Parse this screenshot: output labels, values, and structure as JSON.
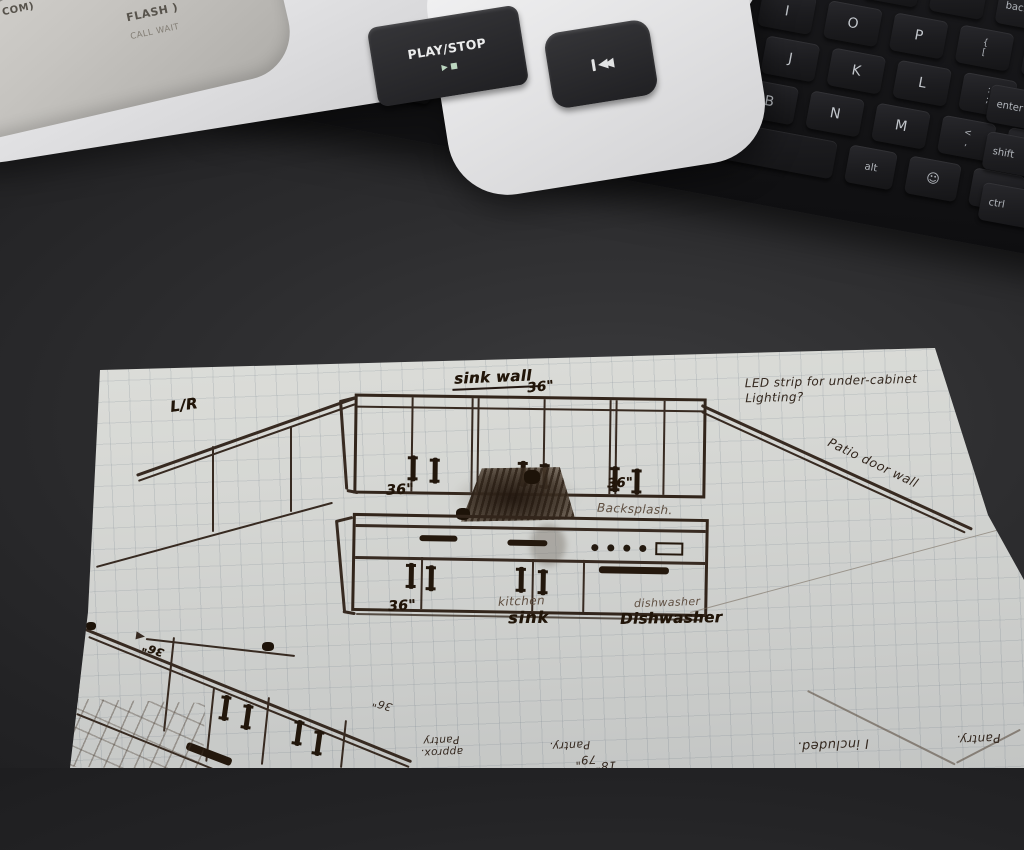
{
  "phone": {
    "com_fragment": "COM",
    "flash_label": "FLASH",
    "speaker_mark": ")",
    "call_wait_label": "CALL WAIT",
    "play_stop_label": "PLAY/STOP",
    "play_icons": "▶ ■",
    "skip_icon_name": "skip-back-icon"
  },
  "keyboard": {
    "rows": {
      "num": [
        "-",
        "=",
        "backspace"
      ],
      "top": [
        "Y",
        "U",
        "I",
        "O",
        "P",
        "{ [",
        "} ]"
      ],
      "home": [
        "A",
        "S",
        "D",
        "F",
        "G",
        "H",
        "J",
        "K",
        "L",
        ": ;",
        "\" '"
      ],
      "z": [
        "shift",
        "fn-lock",
        "Z",
        "X",
        "C",
        "V",
        "B",
        "N",
        "M",
        "< ,",
        "> .",
        "? /"
      ],
      "bottom": [
        "ctrl",
        "fn",
        "win",
        "alt",
        "space",
        "alt",
        "smiley",
        "mic",
        "ctrl"
      ]
    },
    "right_fragments": [
      "enter",
      "shift",
      "ctrl"
    ],
    "smiley_glyph": "☺"
  },
  "paper": {
    "title_text": "sink wall",
    "title_dim": "36\"",
    "corner_mark": "L/R",
    "led_note_line1": "LED strip for under-cabinet",
    "led_note_line2": "Lighting?",
    "upper_dim_left": "36\"",
    "upper_dim_right": "36\"",
    "backsplash": "Backsplash.",
    "patio_wall": "Patio door wall",
    "lower_dim": "36\"",
    "sink_label_light": "kitchen",
    "sink_label_bold": "sink",
    "dishwasher_light": "dishwasher",
    "dishwasher_bold": "Dishwasher",
    "flipped_notes": {
      "approx": "approx.",
      "pantry_a": "Pantry",
      "pantry_b": "Pantry.",
      "pantry_c": "Pantry.",
      "dim_79": "79\"",
      "dim_18": "18\"",
      "included": "I included.",
      "dim_36_a": "36\"",
      "dim_36_b": "36\""
    }
  },
  "colors": {
    "desk": "#232325",
    "paper": "#e2e3de",
    "ink": "#32251b",
    "key_legend": "#b2b6bc",
    "phone_body": "#e9e9eb"
  }
}
